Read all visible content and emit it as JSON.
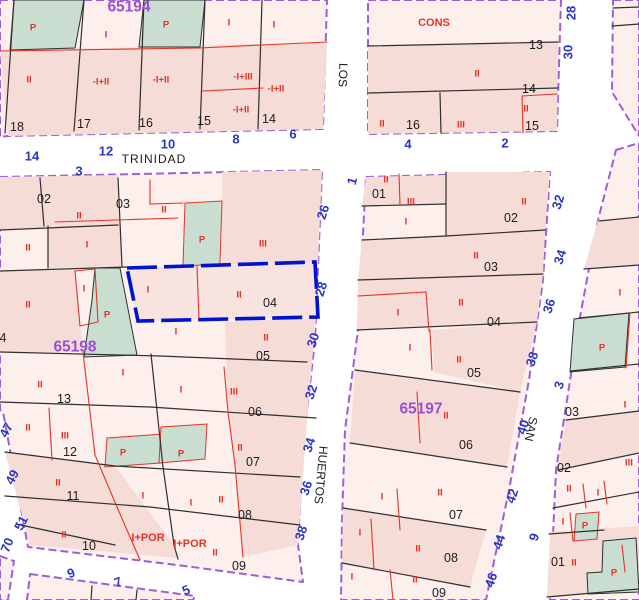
{
  "map": {
    "title": "cadastral-parcel-map",
    "selected_parcel": "04",
    "colors": {
      "block_fill": "#fcefec",
      "block_fill_dark": "#f5dcd6",
      "green_parcel": "#c9ddd1",
      "block_border": "#9d5fd6",
      "parcel_line": "#2f2f2f",
      "subparcel_line": "#e63327",
      "selection_border": "#0013d0",
      "house_number_text": "#2b36c8",
      "parcel_number_text": "#1c1c1c",
      "floor_label_text": "#e63327",
      "block_label_text": "#9a4fd0"
    },
    "block_labels": [
      {
        "t": "65194",
        "x": 129,
        "y": 7
      },
      {
        "t": "65198",
        "x": 75,
        "y": 347
      },
      {
        "t": "65197",
        "x": 421,
        "y": 409
      }
    ],
    "street_names": [
      {
        "t": "TRINIDAD",
        "x": 154,
        "y": 159,
        "r": 0,
        "ls": 1
      },
      {
        "t": "LOS",
        "x": 343,
        "y": 75,
        "r": 92
      },
      {
        "t": "HUERTOS",
        "x": 321,
        "y": 475,
        "r": 95
      },
      {
        "t": "SAN",
        "x": 531,
        "y": 429,
        "r": 102
      }
    ],
    "house_numbers": [
      {
        "t": "14",
        "x": 32,
        "y": 156,
        "r": 0
      },
      {
        "t": "12",
        "x": 106,
        "y": 151,
        "r": 0
      },
      {
        "t": "10",
        "x": 168,
        "y": 144,
        "r": 0
      },
      {
        "t": "8",
        "x": 236,
        "y": 139,
        "r": 0
      },
      {
        "t": "6",
        "x": 293,
        "y": 134,
        "r": 0
      },
      {
        "t": "4",
        "x": 408,
        "y": 144,
        "r": 0
      },
      {
        "t": "2",
        "x": 505,
        "y": 143,
        "r": 0
      },
      {
        "t": "28",
        "x": 571,
        "y": 13,
        "r": -90
      },
      {
        "t": "30",
        "x": 568,
        "y": 52,
        "r": -90
      },
      {
        "t": "3",
        "x": 79,
        "y": 171,
        "r": 0
      },
      {
        "t": "26",
        "x": 323,
        "y": 212,
        "r": -72
      },
      {
        "t": "28",
        "x": 321,
        "y": 289,
        "r": -72
      },
      {
        "t": "30",
        "x": 313,
        "y": 340,
        "r": -72
      },
      {
        "t": "32",
        "x": 311,
        "y": 392,
        "r": -72
      },
      {
        "t": "34",
        "x": 309,
        "y": 445,
        "r": -72
      },
      {
        "t": "36",
        "x": 306,
        "y": 488,
        "r": -72
      },
      {
        "t": "38",
        "x": 301,
        "y": 533,
        "r": -72
      },
      {
        "t": "47",
        "x": 6,
        "y": 430,
        "r": -62
      },
      {
        "t": "49",
        "x": 12,
        "y": 477,
        "r": -62
      },
      {
        "t": "51",
        "x": 21,
        "y": 523,
        "r": -62
      },
      {
        "t": "70",
        "x": 7,
        "y": 545,
        "r": -68
      },
      {
        "t": "9",
        "x": 71,
        "y": 573,
        "r": -22
      },
      {
        "t": "7",
        "x": 118,
        "y": 582,
        "r": -22
      },
      {
        "t": "5",
        "x": 186,
        "y": 590,
        "r": -22
      },
      {
        "t": "1",
        "x": 352,
        "y": 181,
        "r": -75
      },
      {
        "t": "32",
        "x": 558,
        "y": 202,
        "r": -72
      },
      {
        "t": "34",
        "x": 560,
        "y": 257,
        "r": -72
      },
      {
        "t": "36",
        "x": 549,
        "y": 306,
        "r": -72
      },
      {
        "t": "38",
        "x": 532,
        "y": 359,
        "r": -72
      },
      {
        "t": "40",
        "x": 523,
        "y": 427,
        "r": -72
      },
      {
        "t": "42",
        "x": 512,
        "y": 496,
        "r": -72
      },
      {
        "t": "44",
        "x": 499,
        "y": 542,
        "r": -72
      },
      {
        "t": "46",
        "x": 491,
        "y": 580,
        "r": -72
      },
      {
        "t": "3",
        "x": 559,
        "y": 385,
        "r": -72
      },
      {
        "t": "9",
        "x": 534,
        "y": 537,
        "r": -72
      }
    ],
    "parcel_numbers": [
      {
        "t": "18",
        "x": 17,
        "y": 127
      },
      {
        "t": "17",
        "x": 84,
        "y": 124
      },
      {
        "t": "16",
        "x": 146,
        "y": 123
      },
      {
        "t": "15",
        "x": 204,
        "y": 121
      },
      {
        "t": "14",
        "x": 269,
        "y": 119
      },
      {
        "t": "13",
        "x": 536,
        "y": 45
      },
      {
        "t": "14",
        "x": 529,
        "y": 89
      },
      {
        "t": "16",
        "x": 413,
        "y": 125
      },
      {
        "t": "15",
        "x": 532,
        "y": 126
      },
      {
        "t": "02",
        "x": 44,
        "y": 199
      },
      {
        "t": "03",
        "x": 123,
        "y": 204
      },
      {
        "t": "04",
        "x": 270,
        "y": 303
      },
      {
        "t": "05",
        "x": 263,
        "y": 356
      },
      {
        "t": "06",
        "x": 255,
        "y": 412
      },
      {
        "t": "07",
        "x": 253,
        "y": 462
      },
      {
        "t": "08",
        "x": 245,
        "y": 515
      },
      {
        "t": "09",
        "x": 239,
        "y": 566
      },
      {
        "t": "13",
        "x": 64,
        "y": 399
      },
      {
        "t": "12",
        "x": 70,
        "y": 452
      },
      {
        "t": "11",
        "x": 73,
        "y": 496
      },
      {
        "t": "10",
        "x": 89,
        "y": 546
      },
      {
        "t": "4",
        "x": 3,
        "y": 338
      },
      {
        "t": "01",
        "x": 379,
        "y": 194
      },
      {
        "t": "02",
        "x": 511,
        "y": 218
      },
      {
        "t": "03",
        "x": 491,
        "y": 267
      },
      {
        "t": "04",
        "x": 494,
        "y": 322
      },
      {
        "t": "05",
        "x": 474,
        "y": 373
      },
      {
        "t": "06",
        "x": 466,
        "y": 445
      },
      {
        "t": "07",
        "x": 456,
        "y": 515
      },
      {
        "t": "08",
        "x": 451,
        "y": 558
      },
      {
        "t": "09",
        "x": 439,
        "y": 593
      },
      {
        "t": "03",
        "x": 572,
        "y": 412
      },
      {
        "t": "02",
        "x": 564,
        "y": 468
      },
      {
        "t": "01",
        "x": 558,
        "y": 562
      }
    ],
    "floor_labels": [
      {
        "t": "P",
        "x": 33,
        "y": 28
      },
      {
        "t": "I",
        "x": 106,
        "y": 35
      },
      {
        "t": "P",
        "x": 166,
        "y": 25
      },
      {
        "t": "I",
        "x": 229,
        "y": 23
      },
      {
        "t": "I",
        "x": 274,
        "y": 25
      },
      {
        "t": "II",
        "x": 29,
        "y": 80
      },
      {
        "t": "-I+II",
        "x": 101,
        "y": 82
      },
      {
        "t": "-I+II",
        "x": 161,
        "y": 80
      },
      {
        "t": "-I+III",
        "x": 243,
        "y": 77
      },
      {
        "t": "-I+II",
        "x": 276,
        "y": 89
      },
      {
        "t": "-I+II",
        "x": 241,
        "y": 110
      },
      {
        "t": "CONS",
        "x": 434,
        "y": 23,
        "lg": 1
      },
      {
        "t": "II",
        "x": 477,
        "y": 74
      },
      {
        "t": "II",
        "x": 382,
        "y": 124
      },
      {
        "t": "III",
        "x": 461,
        "y": 125
      },
      {
        "t": "II",
        "x": 526,
        "y": 109
      },
      {
        "t": "II",
        "x": 79,
        "y": 216
      },
      {
        "t": "II",
        "x": 164,
        "y": 210
      },
      {
        "t": "P",
        "x": 202,
        "y": 240
      },
      {
        "t": "III",
        "x": 263,
        "y": 244
      },
      {
        "t": "I",
        "x": 87,
        "y": 245
      },
      {
        "t": "II",
        "x": 28,
        "y": 248
      },
      {
        "t": "I",
        "x": 148,
        "y": 290
      },
      {
        "t": "II",
        "x": 239,
        "y": 295
      },
      {
        "t": "II",
        "x": 28,
        "y": 305
      },
      {
        "t": "I",
        "x": 84,
        "y": 289
      },
      {
        "t": "P",
        "x": 107,
        "y": 315
      },
      {
        "t": "I",
        "x": 176,
        "y": 332
      },
      {
        "t": "II",
        "x": 266,
        "y": 338
      },
      {
        "t": "I",
        "x": 123,
        "y": 373
      },
      {
        "t": "II",
        "x": 40,
        "y": 385
      },
      {
        "t": "I",
        "x": 181,
        "y": 390
      },
      {
        "t": "III",
        "x": 234,
        "y": 392
      },
      {
        "t": "II",
        "x": 28,
        "y": 428
      },
      {
        "t": "III",
        "x": 65,
        "y": 436
      },
      {
        "t": "P",
        "x": 123,
        "y": 453
      },
      {
        "t": "P",
        "x": 181,
        "y": 454
      },
      {
        "t": "II",
        "x": 240,
        "y": 448
      },
      {
        "t": "II",
        "x": 58,
        "y": 483
      },
      {
        "t": "I",
        "x": 143,
        "y": 496
      },
      {
        "t": "I",
        "x": 191,
        "y": 503
      },
      {
        "t": "II",
        "x": 221,
        "y": 500
      },
      {
        "t": "II",
        "x": 64,
        "y": 535
      },
      {
        "t": "I+POR",
        "x": 148,
        "y": 538,
        "lg": 1
      },
      {
        "t": "I+POR",
        "x": 190,
        "y": 544,
        "lg": 1
      },
      {
        "t": "II",
        "x": 215,
        "y": 553
      },
      {
        "t": "II",
        "x": 386,
        "y": 180
      },
      {
        "t": "III",
        "x": 411,
        "y": 202
      },
      {
        "t": "I",
        "x": 406,
        "y": 222
      },
      {
        "t": "II",
        "x": 524,
        "y": 202
      },
      {
        "t": "II",
        "x": 476,
        "y": 256
      },
      {
        "t": "II",
        "x": 461,
        "y": 303
      },
      {
        "t": "I",
        "x": 398,
        "y": 313
      },
      {
        "t": "I",
        "x": 410,
        "y": 348
      },
      {
        "t": "II",
        "x": 459,
        "y": 360
      },
      {
        "t": "II",
        "x": 446,
        "y": 416
      },
      {
        "t": "I",
        "x": 382,
        "y": 497
      },
      {
        "t": "II",
        "x": 440,
        "y": 493
      },
      {
        "t": "I",
        "x": 360,
        "y": 533
      },
      {
        "t": "II",
        "x": 418,
        "y": 549
      },
      {
        "t": "I",
        "x": 352,
        "y": 577
      },
      {
        "t": "II",
        "x": 415,
        "y": 580
      },
      {
        "t": "I",
        "x": 620,
        "y": 293
      },
      {
        "t": "P",
        "x": 602,
        "y": 348
      },
      {
        "t": "I",
        "x": 625,
        "y": 405
      },
      {
        "t": "III",
        "x": 629,
        "y": 463
      },
      {
        "t": "II",
        "x": 569,
        "y": 489
      },
      {
        "t": "I",
        "x": 598,
        "y": 493
      },
      {
        "t": "I",
        "x": 563,
        "y": 522
      },
      {
        "t": "P",
        "x": 585,
        "y": 526
      },
      {
        "t": "II",
        "x": 574,
        "y": 563
      },
      {
        "t": "P",
        "x": 614,
        "y": 573
      }
    ]
  }
}
